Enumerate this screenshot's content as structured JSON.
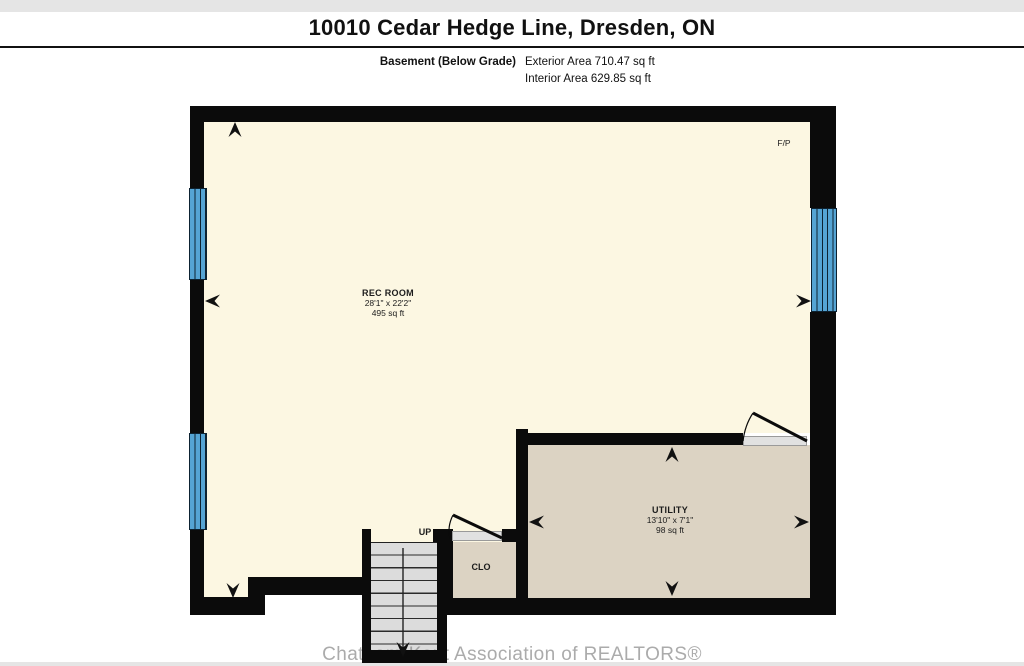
{
  "page": {
    "title": "10010 Cedar Hedge Line, Dresden, ON",
    "floor_label": "Basement (Below Grade)",
    "exterior_area": "Exterior Area 710.47 sq ft",
    "interior_area": "Interior Area 629.85 sq ft",
    "watermark": "Chatham-Kent Association of REALTORS®"
  },
  "rooms": {
    "rec_room": {
      "name": "REC ROOM",
      "dimensions": "28'1\" x 22'2\"",
      "area": "495 sq ft"
    },
    "utility": {
      "name": "UTILITY",
      "dimensions": "13'10\" x 7'1\"",
      "area": "98 sq ft"
    },
    "closet": {
      "label": "CLO"
    },
    "stairs": {
      "label": "UP"
    },
    "fireplace": {
      "label": "F/P"
    }
  },
  "colors": {
    "wall": "#0b0b0b",
    "rec_room_floor": "#FCF7E2",
    "utility_floor": "#DCD3C3",
    "stairs_floor": "#DCDCDC",
    "window": "#55A4D4",
    "watermark_gray": "#787878"
  }
}
